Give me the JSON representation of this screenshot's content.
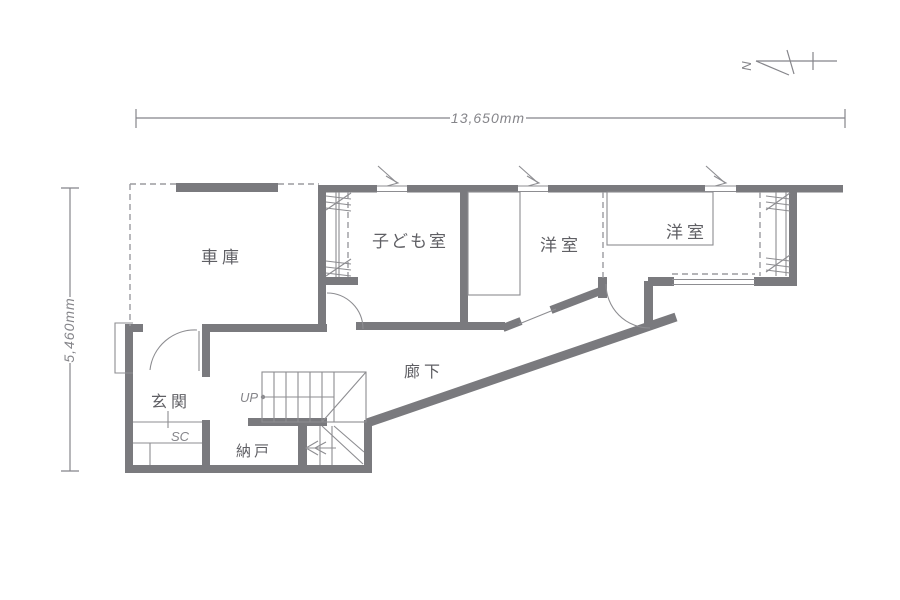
{
  "colors": {
    "bg": "#ffffff",
    "wall": "#7a7a7e",
    "thin": "#8d8d91",
    "dash": "#9b9b9f",
    "dim": "#85858a",
    "text": "#5f5f64"
  },
  "dimensions": {
    "width_label": "13,650mm",
    "height_label": "5,460mm"
  },
  "compass": {
    "north_label": "N"
  },
  "rooms": {
    "garage": "車庫",
    "kids_room": "子ども室",
    "western_room_center": "洋室",
    "western_room_right": "洋室",
    "corridor": "廊下",
    "entrance": "玄関",
    "storage": "納戸"
  },
  "stairs": {
    "up_label": "UP"
  },
  "fixtures": {
    "shoe_closet_label": "SC"
  }
}
